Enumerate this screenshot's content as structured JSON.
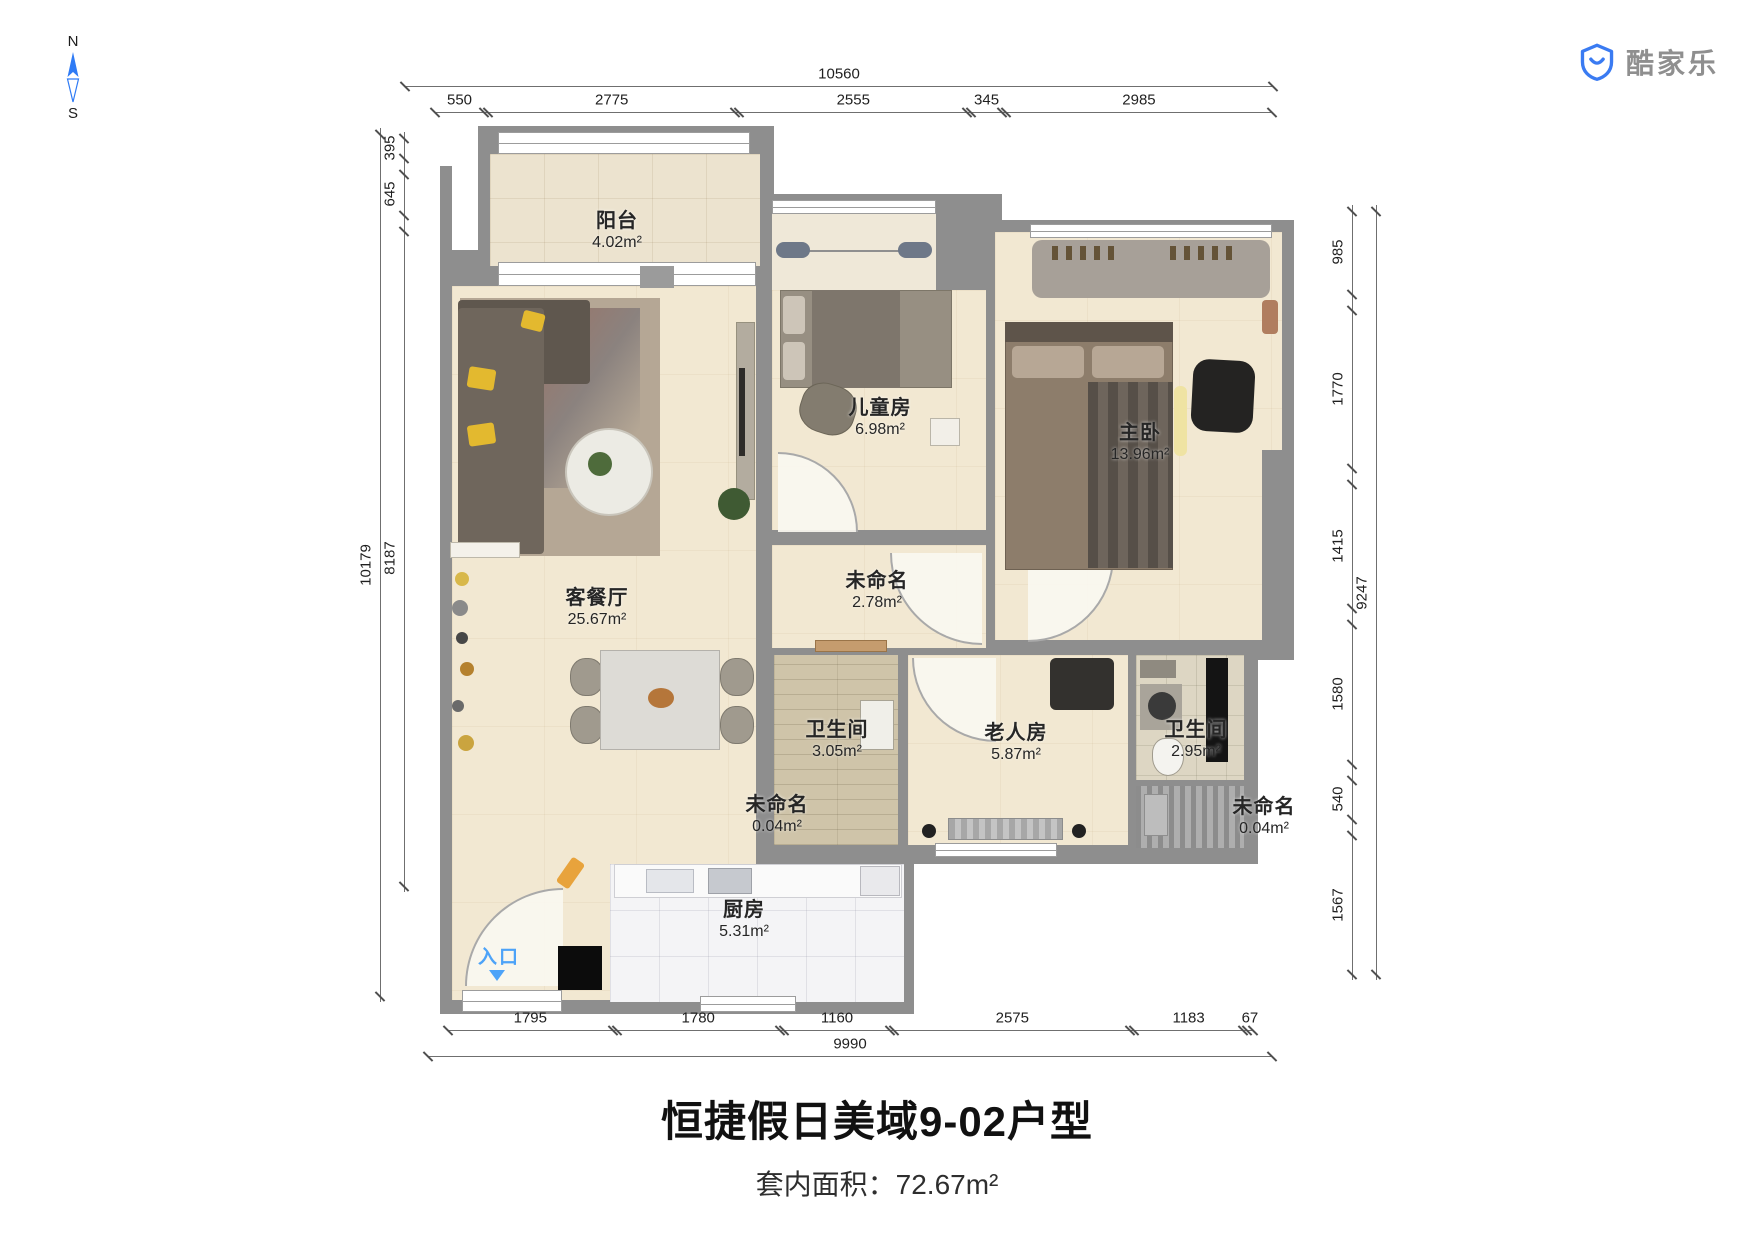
{
  "brand": {
    "name": "酷家乐"
  },
  "compass": {
    "north": "N",
    "south": "S"
  },
  "title": "恒捷假日美域9-02户型",
  "subtitle": {
    "label": "套内面积：",
    "value": "72.67"
  },
  "area_unit": "m²",
  "entrance": {
    "label": "入口"
  },
  "rooms": {
    "balcony": {
      "name": "阳台",
      "area": "4.02"
    },
    "kids": {
      "name": "儿童房",
      "area": "6.98"
    },
    "master": {
      "name": "主卧",
      "area": "13.96"
    },
    "living": {
      "name": "客餐厅",
      "area": "25.67"
    },
    "hall": {
      "name": "未命名",
      "area": "2.78"
    },
    "bath1": {
      "name": "卫生间",
      "area": "3.05"
    },
    "elder": {
      "name": "老人房",
      "area": "5.87"
    },
    "bath2": {
      "name": "卫生间",
      "area": "2.95"
    },
    "niche1": {
      "name": "未命名",
      "area": "0.04"
    },
    "niche2": {
      "name": "未命名",
      "area": "0.04"
    },
    "kitchen": {
      "name": "厨房",
      "area": "5.31"
    }
  },
  "dimensions": {
    "top": {
      "total": "10560",
      "segments": [
        "550",
        "2775",
        "2555",
        "345",
        "2985"
      ]
    },
    "bottom": {
      "total": "9990",
      "segments": [
        "1795",
        "1780",
        "1160",
        "2575",
        "1183",
        "67"
      ]
    },
    "left": {
      "total": "10179",
      "segments": [
        "395",
        "645",
        "8187"
      ]
    },
    "right": {
      "total": "9247",
      "segments": [
        "985",
        "1770",
        "1415",
        "1580",
        "540",
        "1567"
      ]
    }
  },
  "colors": {
    "accent_blue": "#4da3f8",
    "logo_blue": "#3a7bf2",
    "wall": "#8e8e8e",
    "floor_beige": "#f2e8d2",
    "tile_white": "#f4f4f6",
    "dim_text": "#1f1f1f",
    "title": "#111111"
  }
}
